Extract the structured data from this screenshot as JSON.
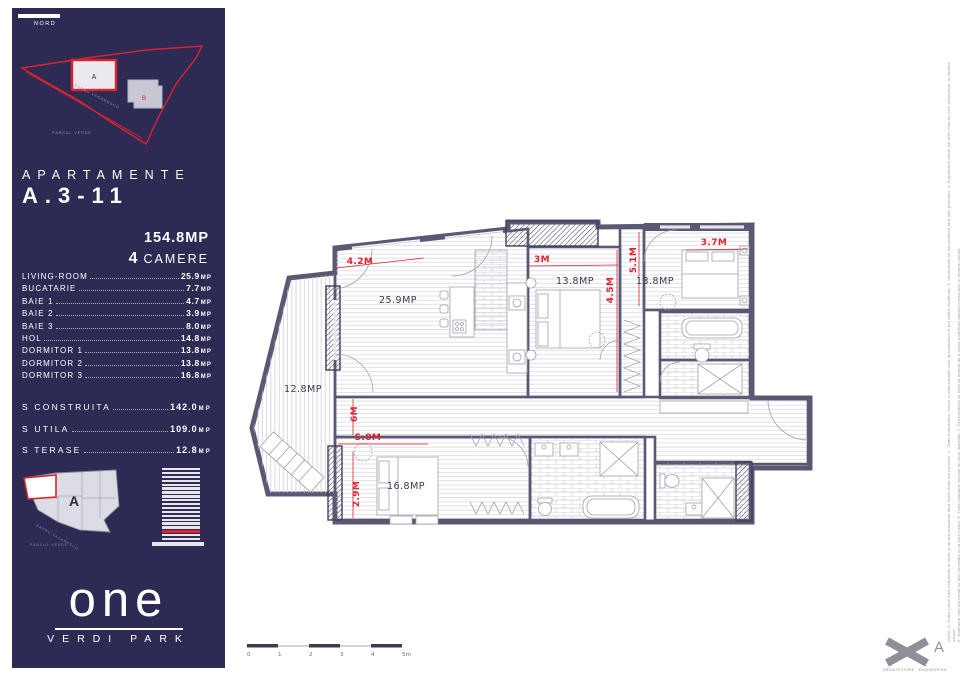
{
  "colors": {
    "navy": "#2d2b54",
    "red": "#d9232e",
    "wall": "#5a5974"
  },
  "sidebar": {
    "north_label": "NORD",
    "site_plan": {
      "building_a": "A",
      "building_b": "B",
      "street": "BARBU VACARESCU",
      "park": "PARCUL VERDE"
    },
    "title_line1": "APARTAMENTE",
    "title_line2": "A.3-11",
    "area_total": "154.8MP",
    "rooms_count": "4",
    "rooms_count_label": "CAMERE",
    "room_list": [
      {
        "label": "LIVING-ROOM",
        "value": "25.9",
        "unit": "MP"
      },
      {
        "label": "BUCATARIE",
        "value": "7.7",
        "unit": "MP"
      },
      {
        "label": "BAIE 1",
        "value": "4.7",
        "unit": "MP"
      },
      {
        "label": "BAIE 2",
        "value": "3.9",
        "unit": "MP"
      },
      {
        "label": "BAIE 3",
        "value": "8.0",
        "unit": "MP"
      },
      {
        "label": "HOL",
        "value": "14.8",
        "unit": "MP"
      },
      {
        "label": "DORMITOR 1",
        "value": "13.8",
        "unit": "MP"
      },
      {
        "label": "DORMITOR 2",
        "value": "13.8",
        "unit": "MP"
      },
      {
        "label": "DORMITOR 3",
        "value": "16.8",
        "unit": "MP"
      }
    ],
    "totals": [
      {
        "label": "S CONSTRUITA",
        "value": "142.0",
        "unit": "MP"
      },
      {
        "label": "S UTILA",
        "value": "109.0",
        "unit": "MP"
      },
      {
        "label": "S TERASE",
        "value": "12.8",
        "unit": "MP"
      }
    ],
    "key_plan": {
      "building_label": "A",
      "street": "BARBU VACARESCU",
      "park": "PARCUL VERDE"
    },
    "tower": {
      "floors": 19,
      "red_floor_from_bottom": 3
    },
    "logo": {
      "name": "one",
      "sub": "VERDI PARK"
    }
  },
  "plan": {
    "room_labels": [
      {
        "text": "25.9MP",
        "x": 398,
        "y": 303
      },
      {
        "text": "13.8MP",
        "x": 575,
        "y": 284
      },
      {
        "text": "13.8MP",
        "x": 655,
        "y": 284
      },
      {
        "text": "12.8MP",
        "x": 303,
        "y": 392
      },
      {
        "text": "16.8MP",
        "x": 406,
        "y": 489
      }
    ],
    "dimensions": [
      {
        "text": "4.2M",
        "x": 360,
        "y": 264,
        "rot": 0
      },
      {
        "text": "3M",
        "x": 542,
        "y": 262,
        "rot": 0
      },
      {
        "text": "3.7M",
        "x": 714,
        "y": 245,
        "rot": 0
      },
      {
        "text": "4.5M",
        "x": 613,
        "y": 290,
        "rot": -90
      },
      {
        "text": "5.1M",
        "x": 636,
        "y": 260,
        "rot": -90
      },
      {
        "text": "6M",
        "x": 357,
        "y": 414,
        "rot": -90
      },
      {
        "text": "5.8M",
        "x": 368,
        "y": 440,
        "rot": 0
      },
      {
        "text": "2.9M",
        "x": 359,
        "y": 494,
        "rot": -90
      }
    ]
  },
  "scale_bar": {
    "ticks": [
      "0",
      "1",
      "2",
      "3",
      "4",
      "5m"
    ]
  },
  "footer": {
    "architect_label": "ARCHITECTURE · ENGINEERING",
    "logo_letter": "A"
  },
  "fine_print": {
    "line1": "NOTA: 1. Toate cotele sunt exprimate in metri si au fost masurate intre fetele finite ale peretilor. 2. Toate materialele, cotele si dimensiunile sunt aproximative si pot suferi modificari. 3. Informatiile se pot schimba fara aviz prealabil. 4. Suprafetele finale pot diferi fata de cele prezentate, in limitele uzuale.",
    "line2": "5. Mobilierul este prezentat cu titlu orientativ si nu este inclus. 6. Toate imaginile folosite au scop ilustrativ. 7. Dezvoltatorul isi rezerva dreptul de a opera modificari asupra proiectului, in limitele uzuale."
  }
}
